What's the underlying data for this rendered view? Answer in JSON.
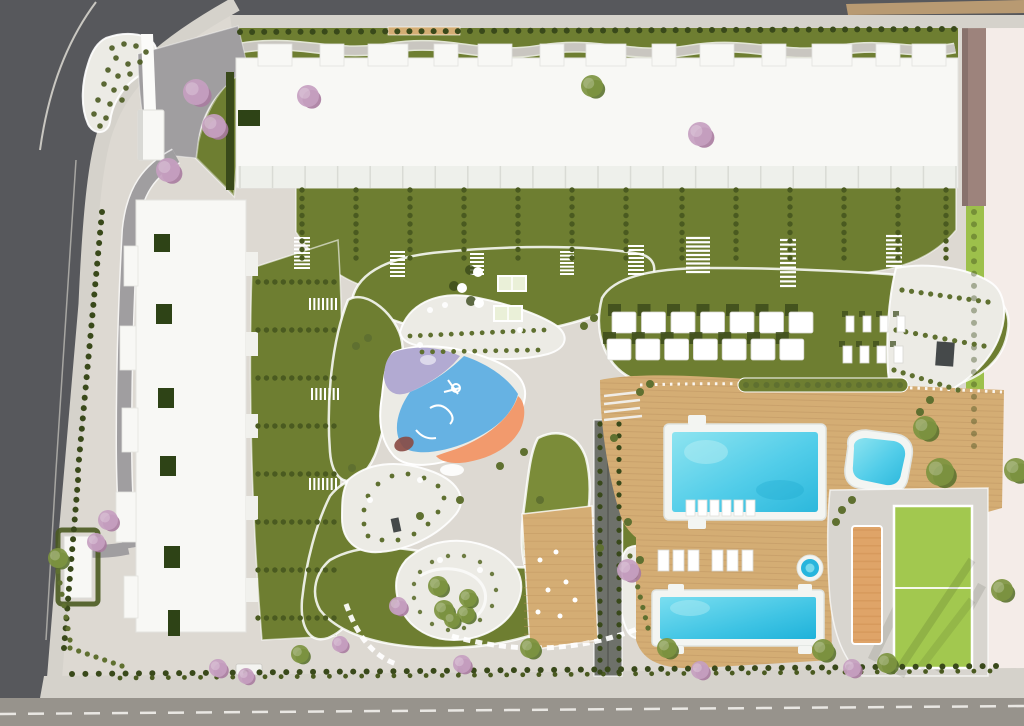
{
  "meta": {
    "title": "residential-complex-site-plan-aerial-render",
    "type": "architectural masterplan, top-down 3D render, no visible text"
  },
  "scene": {
    "features": [
      "perimeter-roads",
      "entrance-plaza-with-canopy",
      "north-apartment-building",
      "west-apartment-building",
      "garage-entrance-pavilion",
      "hedge-garden-plots-with-stairs",
      "central-park-paths",
      "picnic-lawn-with-tables-and-pergolas",
      "playground-colored-surface",
      "white-gravel-gardens",
      "outdoor-gym-wood-deck",
      "shaded-dark-walkway",
      "cabana-lawn",
      "main-swimming-pool",
      "plunge-pool",
      "lap-pool",
      "jacuzzi",
      "wooden-sun-decks",
      "orange-gravel-court",
      "sports-lawn-field",
      "cherry-blossom-trees",
      "palm-trees",
      "perimeter-hedges"
    ],
    "counts": {
      "pools": 3,
      "jacuzzi": 1,
      "cabanas": 14,
      "pool_loungers": 20,
      "picnic_tables": 3,
      "pergola_tables": 2
    }
  },
  "colors": {
    "roadDark": "#57585c",
    "roadMid": "#97938c",
    "sidewalk": "#d5d2cb",
    "base": "#ddd9d2",
    "drive": "#a09ea0",
    "curb": "#c9c7c1",
    "grass": "#6e7e31",
    "grassDark": "#5a6a26",
    "grassBright": "#9dc04b",
    "lawnLight": "#7b8c39",
    "hedge": "#4a5a20",
    "hedgeDark": "#39491a",
    "shrub": "#5f7030",
    "gravel": "#ecebe5",
    "wood": "#d4ad74",
    "woodDark": "#bd9360",
    "rim": "#f3f5f2",
    "water": "#52cde9",
    "waterDeep": "#27b5dd",
    "waterLight": "#9ae8f2",
    "pgPurple": "#b2aad2",
    "pgBlue": "#66b2e3",
    "pgOrange": "#f29a6d",
    "pgDark": "#8a4a42",
    "blossom": "#c6a0c0",
    "blossomDark": "#a87ba0",
    "building": "#f8f8f5",
    "buildingShade": "#e3e3df",
    "patio": "#2e4316",
    "mauve": "#9d837c",
    "cream": "#f4ece8",
    "tan": "#b89a72",
    "darkPath": "#6e716a",
    "palm": "#7d9440",
    "palmDark": "#5c7330",
    "structure": "#45494a",
    "field": "#a2c84f",
    "court": "#dfa468",
    "white": "#ffffff"
  },
  "decorations": [
    {
      "t": "stairs",
      "name": "terrace-dividers",
      "x": 240,
      "y": 166,
      "w": 716,
      "h": 22,
      "n": 22,
      "dir": "v",
      "c": "#d9dbd5",
      "sw": 1.5
    },
    {
      "t": "stairs",
      "name": "gym-planks",
      "x": 524,
      "y": 518,
      "w": 70,
      "h": 124,
      "n": 16,
      "dir": "h",
      "c": "$woodDark",
      "sw": 1,
      "o": 0.4
    },
    {
      "t": "stairs",
      "name": "court-texture",
      "x": 853,
      "y": 530,
      "w": 28,
      "h": 110,
      "n": 14,
      "dir": "h",
      "c": "#cf9254",
      "sw": 1.5,
      "o": 0.55
    },
    {
      "t": "stairs",
      "name": "garden-stairs",
      "x": 294,
      "y": 238,
      "w": 16,
      "h": 30,
      "n": 8,
      "dir": "h",
      "c": "$white",
      "sw": 2
    },
    {
      "t": "stairs",
      "name": "garden-stairs",
      "x": 390,
      "y": 252,
      "w": 15,
      "h": 24,
      "n": 6,
      "dir": "h",
      "c": "$white",
      "sw": 2
    },
    {
      "t": "stairs",
      "name": "garden-stairs",
      "x": 470,
      "y": 254,
      "w": 14,
      "h": 20,
      "n": 5,
      "dir": "h",
      "c": "$white",
      "sw": 2
    },
    {
      "t": "stairs",
      "name": "garden-stairs",
      "x": 560,
      "y": 252,
      "w": 14,
      "h": 22,
      "n": 6,
      "dir": "h",
      "c": "$white",
      "sw": 2
    },
    {
      "t": "stairs",
      "name": "garden-stairs",
      "x": 628,
      "y": 246,
      "w": 16,
      "h": 28,
      "n": 7,
      "dir": "h",
      "c": "$white",
      "sw": 2
    },
    {
      "t": "stairs",
      "name": "garden-stairs",
      "x": 686,
      "y": 238,
      "w": 24,
      "h": 34,
      "n": 8,
      "dir": "h",
      "c": "$white",
      "sw": 2.2
    },
    {
      "t": "stairs",
      "name": "garden-stairs",
      "x": 780,
      "y": 240,
      "w": 16,
      "h": 46,
      "n": 10,
      "dir": "h",
      "c": "$white",
      "sw": 2.2
    },
    {
      "t": "stairs",
      "name": "garden-stairs",
      "x": 886,
      "y": 236,
      "w": 16,
      "h": 30,
      "n": 7,
      "dir": "h",
      "c": "$white",
      "sw": 2.2
    },
    {
      "t": "stairs",
      "name": "garden-stairs",
      "x": 310,
      "y": 298,
      "w": 26,
      "h": 12,
      "n": 6,
      "dir": "v",
      "c": "$white",
      "sw": 2
    },
    {
      "t": "stairs",
      "name": "garden-stairs",
      "x": 312,
      "y": 388,
      "w": 26,
      "h": 12,
      "n": 6,
      "dir": "v",
      "c": "$white",
      "sw": 2
    },
    {
      "t": "stairs",
      "name": "garden-stairs",
      "x": 310,
      "y": 478,
      "w": 26,
      "h": 12,
      "n": 6,
      "dir": "v",
      "c": "$white",
      "sw": 2
    },
    {
      "t": "dots",
      "name": "top-hedgerow",
      "x1": 240,
      "y1": 32,
      "x2": 954,
      "y2": 29,
      "n": 60,
      "r": 3,
      "c": "$hedgeDark"
    },
    {
      "t": "dots",
      "name": "left-hedgerow",
      "x1": 102,
      "y1": 212,
      "x2": 78,
      "y2": 470,
      "n": 26,
      "r": 3,
      "c": "$hedgeDark"
    },
    {
      "t": "dots",
      "name": "left-hedgerow",
      "x1": 78,
      "y1": 480,
      "x2": 64,
      "y2": 648,
      "n": 18,
      "r": 3,
      "c": "$hedgeDark"
    },
    {
      "t": "dots",
      "name": "bottom-hedgerow",
      "x1": 72,
      "y1": 674,
      "x2": 996,
      "y2": 666,
      "n": 70,
      "r": 3,
      "c": "$hedgeDark"
    },
    {
      "t": "dots",
      "name": "bottom-hedgerow",
      "x1": 120,
      "y1": 678,
      "x2": 990,
      "y2": 671,
      "n": 55,
      "r": 2.4,
      "c": "$hedge"
    },
    {
      "t": "dots",
      "name": "corner-shrubs",
      "x1": 56,
      "y1": 560,
      "x2": 70,
      "y2": 640,
      "n": 8,
      "r": 2.6,
      "c": "$shrub"
    },
    {
      "t": "dots",
      "name": "corner-shrubs",
      "x1": 70,
      "y1": 648,
      "x2": 122,
      "y2": 666,
      "n": 7,
      "r": 2.6,
      "c": "$shrub"
    },
    {
      "t": "dots",
      "name": "right-hedge-texture",
      "x1": 974,
      "y1": 212,
      "x2": 974,
      "y2": 446,
      "n": 20,
      "r": 3,
      "c": "$hedgeDark",
      "o": 0.4
    },
    {
      "t": "cols",
      "name": "garden-hedge-columns",
      "xs": [
        302,
        356,
        410,
        464,
        518,
        572,
        626,
        682,
        736,
        790,
        844,
        898,
        946
      ],
      "y1": 190,
      "y2": 258,
      "n": 9,
      "r": 2.7,
      "c": "$hedge"
    },
    {
      "t": "rows",
      "name": "garden-hedge-rows",
      "ys": [
        282,
        330,
        378,
        426,
        474,
        522,
        570,
        618
      ],
      "x1": 258,
      "x2": 334,
      "n": 10,
      "r": 2.7,
      "c": "$hedge"
    },
    {
      "t": "dots",
      "name": "dark-walk-hedge",
      "x1": 600,
      "y1": 424,
      "x2": 600,
      "y2": 672,
      "n": 22,
      "r": 2.6,
      "c": "$hedgeDark"
    },
    {
      "t": "dots",
      "name": "dark-walk-hedge",
      "x1": 619,
      "y1": 424,
      "x2": 619,
      "y2": 672,
      "n": 22,
      "r": 2.6,
      "c": "$hedgeDark"
    },
    {
      "t": "dots",
      "name": "deck-planter-shrubs",
      "x1": 746,
      "y1": 385,
      "x2": 900,
      "y2": 385,
      "n": 16,
      "r": 3,
      "c": "$shrub"
    },
    {
      "t": "dots",
      "name": "gravel-bed-shrubs",
      "x1": 410,
      "y1": 336,
      "x2": 544,
      "y2": 330,
      "n": 14,
      "r": 2.4,
      "c": "$shrub"
    },
    {
      "t": "dots",
      "name": "gravel-bed-shrubs",
      "x1": 422,
      "y1": 352,
      "x2": 538,
      "y2": 350,
      "n": 12,
      "r": 2.4,
      "c": "$shrub"
    },
    {
      "t": "dots",
      "name": "pebble-bed-shrubs",
      "x1": 902,
      "y1": 290,
      "x2": 988,
      "y2": 302,
      "n": 10,
      "r": 2.6,
      "c": "$shrub"
    },
    {
      "t": "dots",
      "name": "pebble-bed-shrubs",
      "x1": 896,
      "y1": 330,
      "x2": 984,
      "y2": 346,
      "n": 10,
      "r": 2.6,
      "c": "$shrub"
    },
    {
      "t": "dots",
      "name": "pebble-bed-shrubs",
      "x1": 894,
      "y1": 370,
      "x2": 958,
      "y2": 390,
      "n": 8,
      "r": 2.6,
      "c": "$shrub"
    },
    {
      "t": "dots",
      "name": "flower-bed-shrubs",
      "x1": 630,
      "y1": 556,
      "x2": 648,
      "y2": 628,
      "n": 8,
      "r": 2.6,
      "c": "$shrub"
    },
    {
      "t": "scatter",
      "name": "entry-island-shrubs",
      "pts": [
        [
          112,
          48
        ],
        [
          124,
          44
        ],
        [
          136,
          46
        ],
        [
          146,
          52
        ],
        [
          140,
          62
        ],
        [
          128,
          64
        ],
        [
          116,
          58
        ],
        [
          108,
          70
        ],
        [
          118,
          76
        ],
        [
          130,
          74
        ],
        [
          104,
          84
        ],
        [
          114,
          90
        ],
        [
          126,
          88
        ],
        [
          98,
          100
        ],
        [
          110,
          104
        ],
        [
          122,
          100
        ],
        [
          94,
          114
        ],
        [
          106,
          118
        ],
        [
          100,
          126
        ]
      ],
      "r": 2.8,
      "c": "$hedge",
      "o": 0.9
    },
    {
      "t": "scatter",
      "name": "shrub-ring",
      "pts": [
        [
          368,
          536
        ],
        [
          382,
          540
        ],
        [
          398,
          540
        ],
        [
          414,
          534
        ],
        [
          428,
          524
        ],
        [
          438,
          512
        ],
        [
          444,
          498
        ],
        [
          438,
          486
        ],
        [
          424,
          478
        ],
        [
          408,
          474
        ],
        [
          392,
          476
        ],
        [
          378,
          484
        ],
        [
          368,
          496
        ],
        [
          364,
          510
        ],
        [
          364,
          524
        ]
      ],
      "r": 2.4,
      "c": "$shrub"
    },
    {
      "t": "scatter",
      "name": "shrub-ring",
      "pts": [
        [
          420,
          572
        ],
        [
          432,
          562
        ],
        [
          448,
          556
        ],
        [
          464,
          556
        ],
        [
          480,
          562
        ],
        [
          492,
          574
        ],
        [
          496,
          590
        ],
        [
          492,
          606
        ],
        [
          480,
          620
        ],
        [
          464,
          628
        ],
        [
          448,
          630
        ],
        [
          432,
          624
        ],
        [
          420,
          612
        ],
        [
          414,
          598
        ],
        [
          414,
          584
        ]
      ],
      "r": 2.2,
      "c": "$shrub",
      "o": 0.9
    },
    {
      "t": "scatter",
      "name": "path-shrubs",
      "pts": [
        [
          356,
          346
        ],
        [
          368,
          338
        ],
        [
          584,
          326
        ],
        [
          594,
          318
        ],
        [
          352,
          468
        ],
        [
          524,
          452
        ],
        [
          614,
          438
        ],
        [
          420,
          516
        ],
        [
          600,
          548
        ],
        [
          640,
          560
        ],
        [
          540,
          500
        ],
        [
          500,
          466
        ],
        [
          460,
          500
        ]
      ],
      "r": 4,
      "c": "$shrub"
    },
    {
      "t": "scatter",
      "name": "poolside-shrubs",
      "pts": [
        [
          640,
          392
        ],
        [
          650,
          384
        ],
        [
          920,
          412
        ],
        [
          930,
          400
        ],
        [
          852,
          500
        ],
        [
          842,
          510
        ],
        [
          628,
          522
        ],
        [
          836,
          522
        ]
      ],
      "r": 4,
      "c": "$shrub"
    },
    {
      "t": "scatter",
      "name": "gravel-boulders",
      "pts": [
        [
          430,
          310
        ],
        [
          445,
          305
        ],
        [
          520,
          330
        ],
        [
          420,
          345
        ],
        [
          370,
          500
        ],
        [
          420,
          480
        ],
        [
          440,
          560
        ],
        [
          480,
          570
        ]
      ],
      "r": 3,
      "c": "$white",
      "o": 0.9
    },
    {
      "t": "row",
      "name": "cabana-shadows",
      "x": 608,
      "y": 304,
      "w": 13,
      "h": 12,
      "n": 7,
      "dx": 29.5,
      "c": "$hedgeDark",
      "o": 0.8
    },
    {
      "t": "row",
      "name": "cabanas",
      "x": 612,
      "y": 312,
      "w": 24,
      "h": 21,
      "n": 7,
      "dx": 29.5,
      "c": "$white",
      "rx": 2,
      "stroke": "#d8d8d2"
    },
    {
      "t": "row",
      "name": "cabana-shadows",
      "x": 603,
      "y": 332,
      "w": 13,
      "h": 12,
      "n": 7,
      "dx": 28.8,
      "c": "$hedgeDark",
      "o": 0.8
    },
    {
      "t": "row",
      "name": "cabanas",
      "x": 607,
      "y": 339,
      "w": 24,
      "h": 21,
      "n": 7,
      "dx": 28.8,
      "c": "$white",
      "rx": 2,
      "stroke": "#d8d8d2"
    },
    {
      "t": "row",
      "name": "lounger-shadows",
      "x": 842,
      "y": 311,
      "w": 6,
      "h": 6,
      "n": 4,
      "dx": 17,
      "c": "$hedgeDark",
      "o": 0.7
    },
    {
      "t": "row",
      "name": "loungers",
      "x": 846,
      "y": 316,
      "w": 8,
      "h": 16,
      "n": 4,
      "dx": 17,
      "c": "$white",
      "stroke": "#d8d8d2"
    },
    {
      "t": "row",
      "name": "lounger-shadows",
      "x": 839,
      "y": 341,
      "w": 6,
      "h": 6,
      "n": 4,
      "dx": 17,
      "c": "$hedgeDark",
      "o": 0.7
    },
    {
      "t": "row",
      "name": "loungers",
      "x": 843,
      "y": 346,
      "w": 9,
      "h": 17,
      "n": 4,
      "dx": 17,
      "c": "$white",
      "stroke": "#d8d8d2"
    },
    {
      "t": "row",
      "name": "pool-loungers",
      "x": 686,
      "y": 500,
      "w": 9,
      "h": 16,
      "n": 6,
      "dx": 12,
      "c": "$white",
      "stroke": "#e0e0da"
    },
    {
      "t": "row",
      "name": "deck-loungers",
      "x": 658,
      "y": 550,
      "w": 11,
      "h": 21,
      "n": 3,
      "dx": 15,
      "c": "$white",
      "stroke": "#d8d8d2"
    },
    {
      "t": "row",
      "name": "deck-loungers",
      "x": 712,
      "y": 550,
      "w": 11,
      "h": 21,
      "n": 3,
      "dx": 15,
      "c": "$white",
      "stroke": "#d8d8d2"
    },
    {
      "t": "scatter",
      "name": "picnic-table-shadows",
      "pts": [
        [
          470,
          270
        ],
        [
          454,
          286
        ],
        [
          471,
          301
        ]
      ],
      "r": 5,
      "c": "$hedgeDark",
      "o": 0.8
    },
    {
      "t": "scatter",
      "name": "picnic-tables",
      "pts": [
        [
          478,
          272
        ],
        [
          462,
          288
        ],
        [
          479,
          303
        ]
      ],
      "r": 5,
      "c": "$white"
    },
    {
      "t": "scatter",
      "name": "gym-equipment",
      "pts": [
        [
          540,
          560
        ],
        [
          556,
          552
        ],
        [
          548,
          590
        ],
        [
          566,
          582
        ],
        [
          538,
          612
        ],
        [
          560,
          616
        ],
        [
          575,
          600
        ]
      ],
      "r": 2.5,
      "c": "$white"
    },
    {
      "t": "trees",
      "name": "blossom-tree",
      "pts": [
        [
          196,
          92,
          13
        ],
        [
          214,
          126,
          12
        ],
        [
          168,
          170,
          12
        ],
        [
          308,
          96,
          11
        ],
        [
          700,
          134,
          12
        ],
        [
          108,
          520,
          10
        ],
        [
          96,
          542,
          9
        ],
        [
          628,
          570,
          11
        ],
        [
          398,
          606,
          9
        ],
        [
          340,
          644,
          8
        ],
        [
          218,
          668,
          9
        ],
        [
          246,
          676,
          8
        ],
        [
          462,
          664,
          9
        ],
        [
          700,
          670,
          9
        ],
        [
          852,
          668,
          9
        ]
      ],
      "c": "$blossom",
      "c2": "$blossomDark"
    },
    {
      "t": "trees",
      "name": "green-tree",
      "pts": [
        [
          592,
          86,
          11
        ],
        [
          444,
          610,
          10
        ],
        [
          466,
          614,
          9
        ],
        [
          925,
          428,
          12
        ],
        [
          940,
          472,
          14
        ],
        [
          1016,
          470,
          12
        ],
        [
          530,
          648,
          10
        ],
        [
          667,
          648,
          10
        ],
        [
          823,
          650,
          11
        ],
        [
          887,
          663,
          10
        ],
        [
          1002,
          590,
          11
        ],
        [
          58,
          558,
          10
        ],
        [
          300,
          654,
          9
        ],
        [
          438,
          586,
          10
        ],
        [
          468,
          598,
          9
        ],
        [
          452,
          620,
          8
        ]
      ],
      "c": "$palm",
      "c2": "$palmDark"
    }
  ]
}
